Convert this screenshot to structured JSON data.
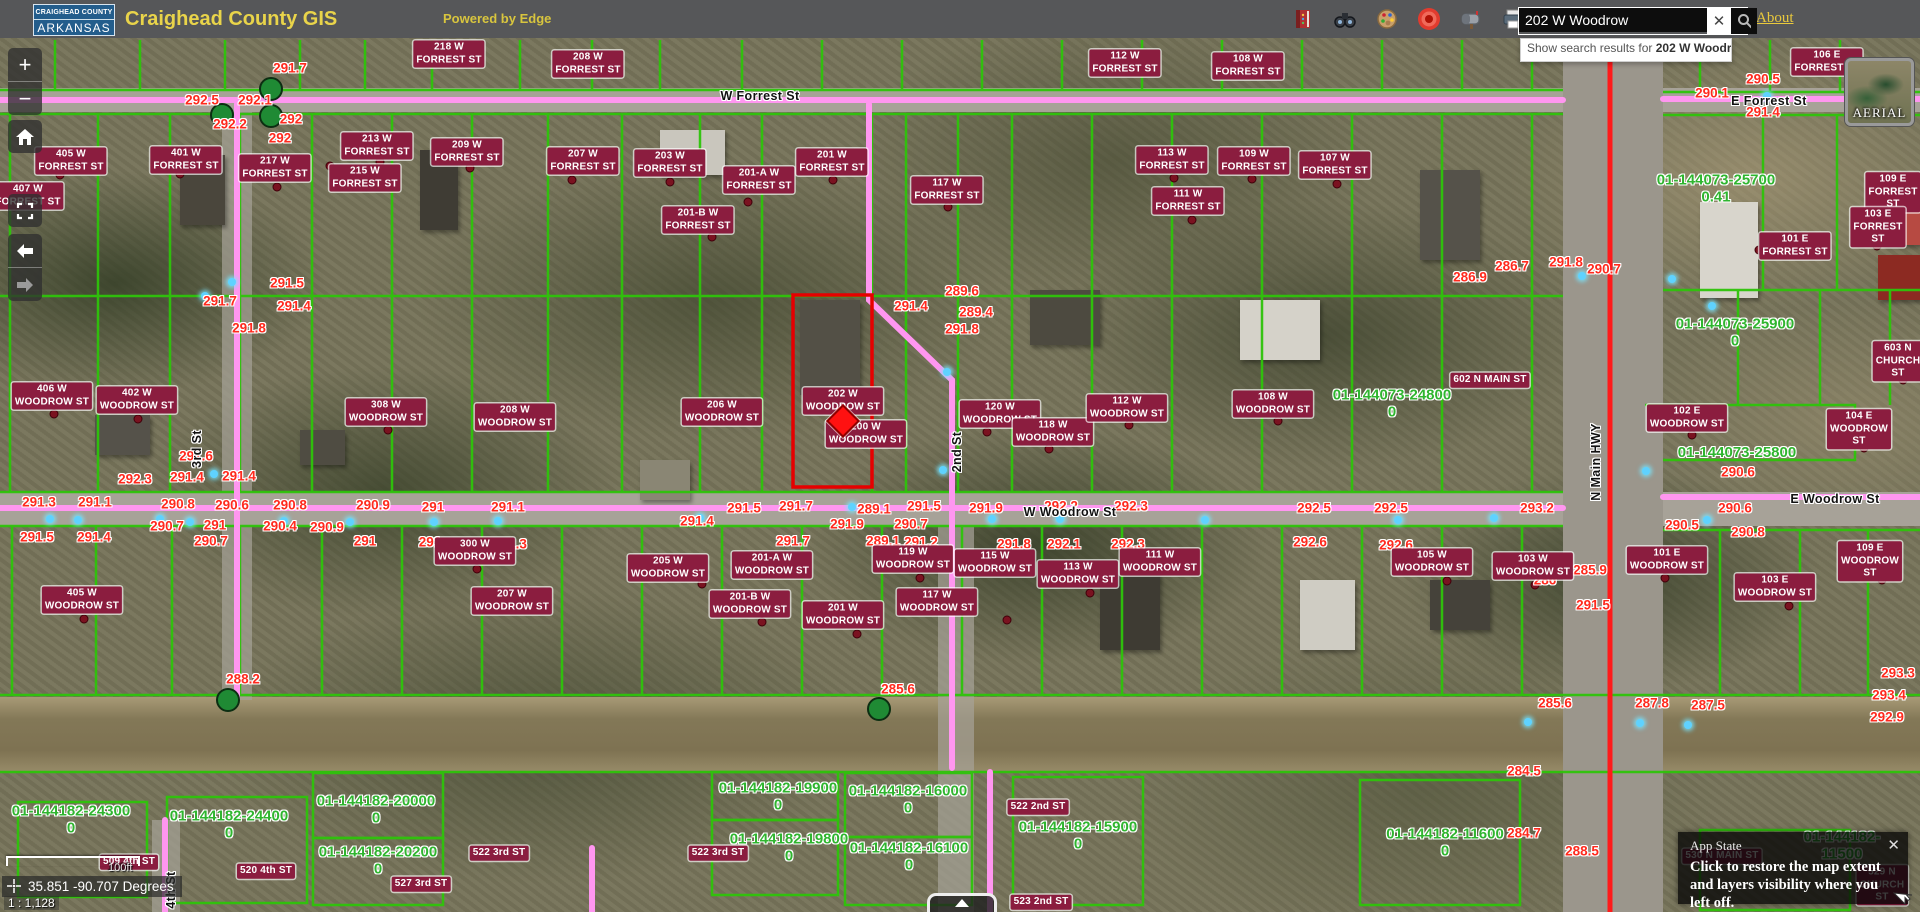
{
  "header": {
    "logo": {
      "line1": "CRAIGHEAD COUNTY",
      "line2": "ARKANSAS"
    },
    "title": "Craighead County GIS",
    "powered": "Powered by Edge",
    "about": "About",
    "search": {
      "value": "202 W Woodrow",
      "clear_glyph": "✕"
    },
    "toolbar_icons": [
      "legend-book",
      "binoculars-search",
      "draw-palette",
      "locate-target",
      "mailbox-report",
      "printer",
      "folder-open"
    ]
  },
  "suggestion": {
    "prefix": "Show search results for ",
    "term": "202 W Woodr..."
  },
  "controls": {
    "zoom_in": "+",
    "zoom_out": "−"
  },
  "basemap": {
    "label": "AERIAL"
  },
  "statusbar": {
    "scale_label": "100ft",
    "coords": "35.851 -90.707 Degrees",
    "ratio": "1 : 1,128"
  },
  "app_state": {
    "title": "App State",
    "close_glyph": "✕",
    "message": "Click to restore the map extent and layers visibility where you left off."
  },
  "colors": {
    "parcel_green": "#2ec40a",
    "highlight_red": "#e60000",
    "road_pink": "#ff96f0",
    "highway_red": "#ff1a1a",
    "address_chip": "#8b1d3f",
    "elevation_red": "#ff2a1e",
    "parcel_id_green": "#2fb52f",
    "header_yellow": "#e9d44a"
  },
  "map": {
    "highlight_parcel": {
      "x": 793,
      "y": 295,
      "w": 79,
      "h": 192,
      "marker_x": 843,
      "marker_y": 421
    },
    "streets": [
      {
        "t": "W Forrest St",
        "x": 760,
        "y": 96,
        "r": 0
      },
      {
        "t": "E Forrest St",
        "x": 1769,
        "y": 101,
        "r": 0
      },
      {
        "t": "W Woodrow St",
        "x": 1070,
        "y": 512,
        "r": 0
      },
      {
        "t": "E Woodrow St",
        "x": 1835,
        "y": 499,
        "r": 0
      },
      {
        "t": "2nd St",
        "x": 957,
        "y": 452,
        "r": -90
      },
      {
        "t": "3rd St",
        "x": 197,
        "y": 449,
        "r": -90
      },
      {
        "t": "4th St",
        "x": 171,
        "y": 890,
        "r": -90
      },
      {
        "t": "N Main HWY",
        "x": 1596,
        "y": 462,
        "r": -90
      }
    ],
    "addresses": [
      {
        "t": "218 W\nFORREST ST",
        "x": 449,
        "y": 54
      },
      {
        "t": "208 W\nFORREST ST",
        "x": 588,
        "y": 64
      },
      {
        "t": "112 W\nFORREST ST",
        "x": 1125,
        "y": 63
      },
      {
        "t": "108 W\nFORREST ST",
        "x": 1248,
        "y": 66
      },
      {
        "t": "106 E\nFORREST ST",
        "x": 1827,
        "y": 62
      },
      {
        "t": "405 W\nFORREST ST",
        "x": 71,
        "y": 161
      },
      {
        "t": "401 W\nFORREST ST",
        "x": 186,
        "y": 160
      },
      {
        "t": "407 W\nFORREST ST",
        "x": 28,
        "y": 196
      },
      {
        "t": "217 W\nFORREST ST",
        "x": 275,
        "y": 168
      },
      {
        "t": "215 W\nFORREST ST",
        "x": 365,
        "y": 178
      },
      {
        "t": "213 W\nFORREST ST",
        "x": 377,
        "y": 146
      },
      {
        "t": "209 W\nFORREST ST",
        "x": 467,
        "y": 152
      },
      {
        "t": "207 W\nFORREST ST",
        "x": 583,
        "y": 161
      },
      {
        "t": "203 W\nFORREST ST",
        "x": 670,
        "y": 163
      },
      {
        "t": "201-A W\nFORREST ST",
        "x": 759,
        "y": 180
      },
      {
        "t": "201-B W\nFORREST ST",
        "x": 698,
        "y": 220
      },
      {
        "t": "201 W\nFORREST ST",
        "x": 832,
        "y": 162
      },
      {
        "t": "117 W\nFORREST ST",
        "x": 947,
        "y": 190
      },
      {
        "t": "113 W\nFORREST ST",
        "x": 1172,
        "y": 160
      },
      {
        "t": "109 W\nFORREST ST",
        "x": 1254,
        "y": 161
      },
      {
        "t": "111 W\nFORREST ST",
        "x": 1188,
        "y": 201
      },
      {
        "t": "107 W\nFORREST ST",
        "x": 1335,
        "y": 165
      },
      {
        "t": "109 E\nFORREST ST",
        "x": 1893,
        "y": 192
      },
      {
        "t": "103 E\nFORREST ST",
        "x": 1878,
        "y": 227
      },
      {
        "t": "101 E\nFORREST ST",
        "x": 1795,
        "y": 246
      },
      {
        "t": "406 W\nWOODROW ST",
        "x": 52,
        "y": 396
      },
      {
        "t": "402 W\nWOODROW ST",
        "x": 137,
        "y": 400
      },
      {
        "t": "308 W\nWOODROW ST",
        "x": 386,
        "y": 412
      },
      {
        "t": "208 W\nWOODROW ST",
        "x": 515,
        "y": 417
      },
      {
        "t": "206 W\nWOODROW ST",
        "x": 722,
        "y": 412
      },
      {
        "t": "202 W\nWOODROW ST",
        "x": 843,
        "y": 401
      },
      {
        "t": "200 W\nWOODROW ST",
        "x": 866,
        "y": 434
      },
      {
        "t": "120 W\nWOODROW ST",
        "x": 1000,
        "y": 414
      },
      {
        "t": "118 W\nWOODROW ST",
        "x": 1053,
        "y": 432
      },
      {
        "t": "112 W\nWOODROW ST",
        "x": 1127,
        "y": 408
      },
      {
        "t": "108 W\nWOODROW ST",
        "x": 1273,
        "y": 404
      },
      {
        "t": "102 E\nWOODROW ST",
        "x": 1687,
        "y": 418
      },
      {
        "t": "104 E\nWOODROW ST",
        "x": 1859,
        "y": 429
      },
      {
        "t": "602 N MAIN ST",
        "x": 1490,
        "y": 380
      },
      {
        "t": "405 W\nWOODROW ST",
        "x": 82,
        "y": 600
      },
      {
        "t": "300 W\nWOODROW ST",
        "x": 475,
        "y": 551
      },
      {
        "t": "207 W\nWOODROW ST",
        "x": 512,
        "y": 601
      },
      {
        "t": "205 W\nWOODROW ST",
        "x": 668,
        "y": 568
      },
      {
        "t": "201-A W\nWOODROW ST",
        "x": 772,
        "y": 565
      },
      {
        "t": "201-B W\nWOODROW ST",
        "x": 750,
        "y": 604
      },
      {
        "t": "201 W\nWOODROW ST",
        "x": 843,
        "y": 615
      },
      {
        "t": "119 W\nWOODROW ST",
        "x": 913,
        "y": 559
      },
      {
        "t": "117 W\nWOODROW ST",
        "x": 937,
        "y": 602
      },
      {
        "t": "115 W\nWOODROW ST",
        "x": 995,
        "y": 563
      },
      {
        "t": "113 W\nWOODROW ST",
        "x": 1078,
        "y": 574
      },
      {
        "t": "111 W\nWOODROW ST",
        "x": 1160,
        "y": 562
      },
      {
        "t": "105 W\nWOODROW ST",
        "x": 1432,
        "y": 562
      },
      {
        "t": "103 W\nWOODROW ST",
        "x": 1533,
        "y": 566
      },
      {
        "t": "101 E\nWOODROW ST",
        "x": 1667,
        "y": 560
      },
      {
        "t": "103 E\nWOODROW ST",
        "x": 1775,
        "y": 587
      },
      {
        "t": "109 E\nWOODROW ST",
        "x": 1870,
        "y": 561
      },
      {
        "t": "603 N\nCHURCH ST",
        "x": 1898,
        "y": 361
      },
      {
        "t": "509 4th ST",
        "x": 129,
        "y": 862
      },
      {
        "t": "520 4th ST",
        "x": 266,
        "y": 871
      },
      {
        "t": "527 3rd ST",
        "x": 421,
        "y": 884
      },
      {
        "t": "522 3rd ST",
        "x": 499,
        "y": 853
      },
      {
        "t": "522 3rd ST",
        "x": 718,
        "y": 853
      },
      {
        "t": "523 2nd ST",
        "x": 1041,
        "y": 902
      },
      {
        "t": "522 2nd ST",
        "x": 1038,
        "y": 807
      },
      {
        "t": "530 N MAIN ST",
        "x": 1722,
        "y": 856
      },
      {
        "t": "529 N\nCHURCH ST",
        "x": 1882,
        "y": 885
      }
    ],
    "parcels": [
      {
        "t": "01-144073-25700",
        "v": "0.41",
        "x": 1716,
        "y": 189
      },
      {
        "t": "01-144073-25900",
        "v": "0",
        "x": 1735,
        "y": 333
      },
      {
        "t": "01-144073-24800",
        "v": "0",
        "x": 1392,
        "y": 404
      },
      {
        "t": "01-144073-25800",
        "v": "",
        "x": 1737,
        "y": 453
      },
      {
        "t": "01-144182-24300",
        "v": "0",
        "x": 71,
        "y": 820
      },
      {
        "t": "01-144182-24400",
        "v": "0",
        "x": 229,
        "y": 825
      },
      {
        "t": "01-144182-20000",
        "v": "0",
        "x": 376,
        "y": 810
      },
      {
        "t": "01-144182-20200",
        "v": "0",
        "x": 378,
        "y": 861
      },
      {
        "t": "01-144182-19900",
        "v": "0",
        "x": 778,
        "y": 797
      },
      {
        "t": "01-144182-19800",
        "v": "0",
        "x": 789,
        "y": 848
      },
      {
        "t": "01-144182-16000",
        "v": "0",
        "x": 908,
        "y": 800
      },
      {
        "t": "01-144182-16100",
        "v": "0",
        "x": 909,
        "y": 857
      },
      {
        "t": "01-144182-15900",
        "v": "0",
        "x": 1078,
        "y": 836
      },
      {
        "t": "01-144182-11600",
        "v": "0",
        "x": 1445,
        "y": 843
      },
      {
        "t": "01-144182-11500",
        "v": "",
        "x": 1842,
        "y": 846
      }
    ],
    "elevations": [
      {
        "t": "291.7",
        "x": 290,
        "y": 68
      },
      {
        "t": "292.5",
        "x": 202,
        "y": 100
      },
      {
        "t": "292.1",
        "x": 255,
        "y": 100
      },
      {
        "t": "292.2",
        "x": 230,
        "y": 124
      },
      {
        "t": "292",
        "x": 291,
        "y": 119
      },
      {
        "t": "292",
        "x": 280,
        "y": 138
      },
      {
        "t": "291.5",
        "x": 287,
        "y": 283
      },
      {
        "t": "291.7",
        "x": 220,
        "y": 301
      },
      {
        "t": "291.4",
        "x": 294,
        "y": 306
      },
      {
        "t": "291.8",
        "x": 249,
        "y": 328
      },
      {
        "t": "289.6",
        "x": 962,
        "y": 291
      },
      {
        "t": "291.4",
        "x": 911,
        "y": 306
      },
      {
        "t": "289.4",
        "x": 976,
        "y": 312
      },
      {
        "t": "291.8",
        "x": 962,
        "y": 329
      },
      {
        "t": "290.1",
        "x": 1712,
        "y": 93
      },
      {
        "t": "290.5",
        "x": 1763,
        "y": 79
      },
      {
        "t": "291.4",
        "x": 1763,
        "y": 112
      },
      {
        "t": "286.9",
        "x": 1470,
        "y": 277
      },
      {
        "t": "286.7",
        "x": 1512,
        "y": 266
      },
      {
        "t": "291.8",
        "x": 1566,
        "y": 262
      },
      {
        "t": "290.7",
        "x": 1604,
        "y": 269
      },
      {
        "t": "291.6",
        "x": 196,
        "y": 456
      },
      {
        "t": "292.3",
        "x": 135,
        "y": 479
      },
      {
        "t": "291.4",
        "x": 187,
        "y": 477
      },
      {
        "t": "291.4",
        "x": 239,
        "y": 476
      },
      {
        "t": "291.3",
        "x": 39,
        "y": 502
      },
      {
        "t": "291.1",
        "x": 95,
        "y": 502
      },
      {
        "t": "290.8",
        "x": 178,
        "y": 504
      },
      {
        "t": "290.6",
        "x": 232,
        "y": 505
      },
      {
        "t": "290.8",
        "x": 290,
        "y": 505
      },
      {
        "t": "290.9",
        "x": 373,
        "y": 505
      },
      {
        "t": "291",
        "x": 433,
        "y": 507
      },
      {
        "t": "291.1",
        "x": 508,
        "y": 507
      },
      {
        "t": "291.5",
        "x": 37,
        "y": 537
      },
      {
        "t": "291.4",
        "x": 94,
        "y": 537
      },
      {
        "t": "290.7",
        "x": 167,
        "y": 526
      },
      {
        "t": "291",
        "x": 215,
        "y": 525
      },
      {
        "t": "290.7",
        "x": 211,
        "y": 541
      },
      {
        "t": "290.4",
        "x": 280,
        "y": 526
      },
      {
        "t": "290.9",
        "x": 327,
        "y": 527
      },
      {
        "t": "291",
        "x": 365,
        "y": 541
      },
      {
        "t": "291",
        "x": 430,
        "y": 542
      },
      {
        "t": "291.3",
        "x": 510,
        "y": 544
      },
      {
        "t": "291.5",
        "x": 744,
        "y": 508
      },
      {
        "t": "291.7",
        "x": 796,
        "y": 506
      },
      {
        "t": "289.1",
        "x": 874,
        "y": 509
      },
      {
        "t": "291.5",
        "x": 924,
        "y": 506
      },
      {
        "t": "291.9",
        "x": 986,
        "y": 508
      },
      {
        "t": "292.2",
        "x": 1061,
        "y": 506
      },
      {
        "t": "292.3",
        "x": 1131,
        "y": 506
      },
      {
        "t": "292.5",
        "x": 1314,
        "y": 508
      },
      {
        "t": "292.5",
        "x": 1391,
        "y": 508
      },
      {
        "t": "293.2",
        "x": 1537,
        "y": 508
      },
      {
        "t": "290.6",
        "x": 1735,
        "y": 508
      },
      {
        "t": "291.4",
        "x": 697,
        "y": 521
      },
      {
        "t": "291.9",
        "x": 847,
        "y": 524
      },
      {
        "t": "290.7",
        "x": 911,
        "y": 524
      },
      {
        "t": "289.1",
        "x": 883,
        "y": 541
      },
      {
        "t": "291.2",
        "x": 921,
        "y": 542
      },
      {
        "t": "291.7",
        "x": 793,
        "y": 541
      },
      {
        "t": "291.8",
        "x": 1014,
        "y": 544
      },
      {
        "t": "292.1",
        "x": 1064,
        "y": 544
      },
      {
        "t": "292.3",
        "x": 1128,
        "y": 544
      },
      {
        "t": "292.6",
        "x": 1310,
        "y": 542
      },
      {
        "t": "292.6",
        "x": 1396,
        "y": 545
      },
      {
        "t": "290.6",
        "x": 1738,
        "y": 472
      },
      {
        "t": "290.5",
        "x": 1682,
        "y": 525
      },
      {
        "t": "290.8",
        "x": 1748,
        "y": 532
      },
      {
        "t": "292.1",
        "x": 1660,
        "y": 557
      },
      {
        "t": "285.9",
        "x": 1590,
        "y": 570
      },
      {
        "t": "286",
        "x": 1545,
        "y": 580
      },
      {
        "t": "291.5",
        "x": 1593,
        "y": 605
      },
      {
        "t": "288.2",
        "x": 243,
        "y": 679
      },
      {
        "t": "285.6",
        "x": 898,
        "y": 689
      },
      {
        "t": "285.6",
        "x": 1555,
        "y": 703
      },
      {
        "t": "287.8",
        "x": 1652,
        "y": 703
      },
      {
        "t": "287.5",
        "x": 1708,
        "y": 705
      },
      {
        "t": "293.3",
        "x": 1898,
        "y": 673
      },
      {
        "t": "293.4",
        "x": 1889,
        "y": 695
      },
      {
        "t": "292.9",
        "x": 1887,
        "y": 717
      },
      {
        "t": "284.5",
        "x": 1524,
        "y": 771
      },
      {
        "t": "284.7",
        "x": 1524,
        "y": 833
      },
      {
        "t": "288.5",
        "x": 1582,
        "y": 851
      }
    ],
    "benchmarks": [
      [
        214,
        474
      ],
      [
        50,
        519
      ],
      [
        78,
        520
      ],
      [
        160,
        519
      ],
      [
        190,
        522
      ],
      [
        284,
        521
      ],
      [
        350,
        522
      ],
      [
        434,
        522
      ],
      [
        498,
        521
      ],
      [
        700,
        518
      ],
      [
        852,
        507
      ],
      [
        947,
        372
      ],
      [
        943,
        470
      ],
      [
        992,
        519
      ],
      [
        1060,
        519
      ],
      [
        1205,
        520
      ],
      [
        1398,
        520
      ],
      [
        1494,
        518
      ],
      [
        1582,
        276
      ],
      [
        1672,
        279
      ],
      [
        1767,
        96
      ],
      [
        1712,
        306
      ],
      [
        1646,
        471
      ],
      [
        1707,
        520
      ],
      [
        1528,
        722
      ],
      [
        1640,
        723
      ],
      [
        1688,
        725
      ],
      [
        205,
        296
      ],
      [
        232,
        282
      ]
    ],
    "address_points": [
      [
        60,
        175
      ],
      [
        180,
        174
      ],
      [
        14,
        207
      ],
      [
        277,
        187
      ],
      [
        330,
        166
      ],
      [
        380,
        162
      ],
      [
        470,
        168
      ],
      [
        572,
        180
      ],
      [
        670,
        182
      ],
      [
        748,
        202
      ],
      [
        712,
        237
      ],
      [
        833,
        180
      ],
      [
        948,
        207
      ],
      [
        1174,
        178
      ],
      [
        1252,
        179
      ],
      [
        1192,
        220
      ],
      [
        1337,
        184
      ],
      [
        1895,
        210
      ],
      [
        1877,
        246
      ],
      [
        1759,
        250
      ],
      [
        54,
        414
      ],
      [
        138,
        419
      ],
      [
        388,
        430
      ],
      [
        877,
        424
      ],
      [
        987,
        432
      ],
      [
        1049,
        449
      ],
      [
        1129,
        425
      ],
      [
        1278,
        421
      ],
      [
        1692,
        435
      ],
      [
        1864,
        448
      ],
      [
        84,
        619
      ],
      [
        477,
        569
      ],
      [
        702,
        584
      ],
      [
        762,
        622
      ],
      [
        857,
        634
      ],
      [
        920,
        578
      ],
      [
        1007,
        620
      ],
      [
        1090,
        593
      ],
      [
        1447,
        581
      ],
      [
        1535,
        585
      ],
      [
        1665,
        578
      ],
      [
        1789,
        606
      ],
      [
        1882,
        580
      ],
      [
        1903,
        380
      ]
    ],
    "monuments": [
      [
        271,
        89
      ],
      [
        222,
        115
      ],
      [
        271,
        116
      ],
      [
        228,
        700
      ],
      [
        879,
        709
      ]
    ]
  }
}
